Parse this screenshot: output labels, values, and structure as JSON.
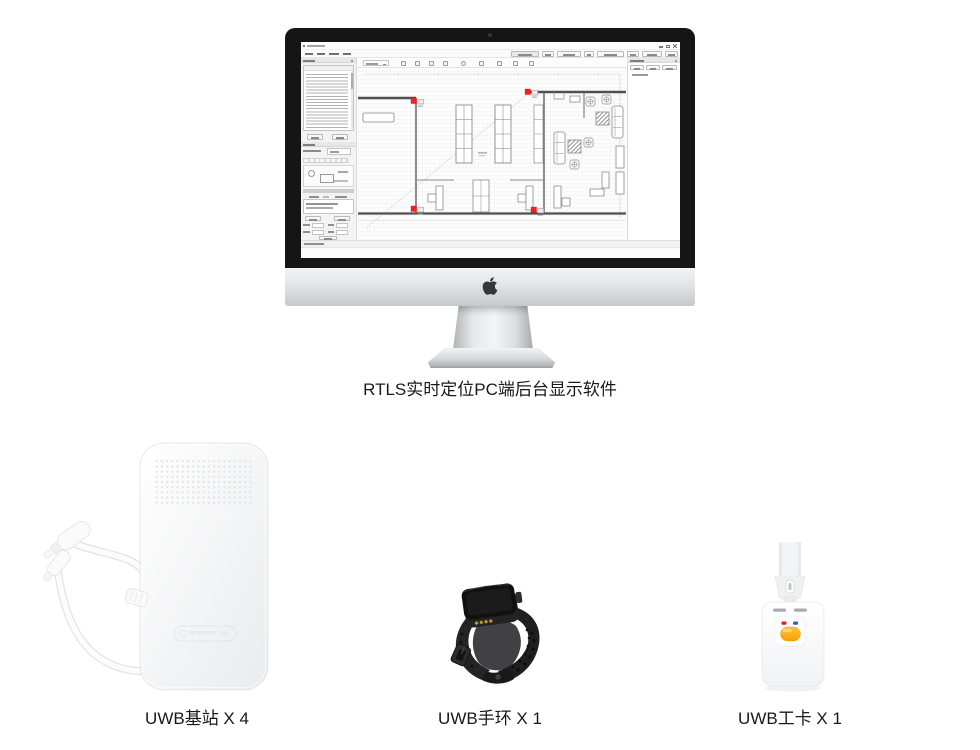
{
  "page": {
    "caption": "RTLS实时定位PC端后台显示软件",
    "products": [
      {
        "name": "uwb-anchor",
        "label": "UWB基站 X 4"
      },
      {
        "name": "uwb-wristband",
        "label": "UWB手环 X 1"
      },
      {
        "name": "uwb-badge",
        "label": "UWB工卡 X 1"
      }
    ]
  },
  "software_screen": {
    "anchor_marker_count": 4,
    "anchor_marker_color": "#fa1f1f"
  },
  "colors": {
    "bezel_black": "#151515",
    "aluminum_silver": "#d9dadc",
    "badge_button_orange": "#f8a81b",
    "badge_led_red": "#e02020",
    "badge_led_blue": "#2b5fd0",
    "watch_contact_gold": "#c79a3e"
  },
  "icons": [
    "apple-logo-icon",
    "start-icon",
    "search-icon",
    "chrome-icon",
    "edge-icon",
    "folder-icon"
  ]
}
